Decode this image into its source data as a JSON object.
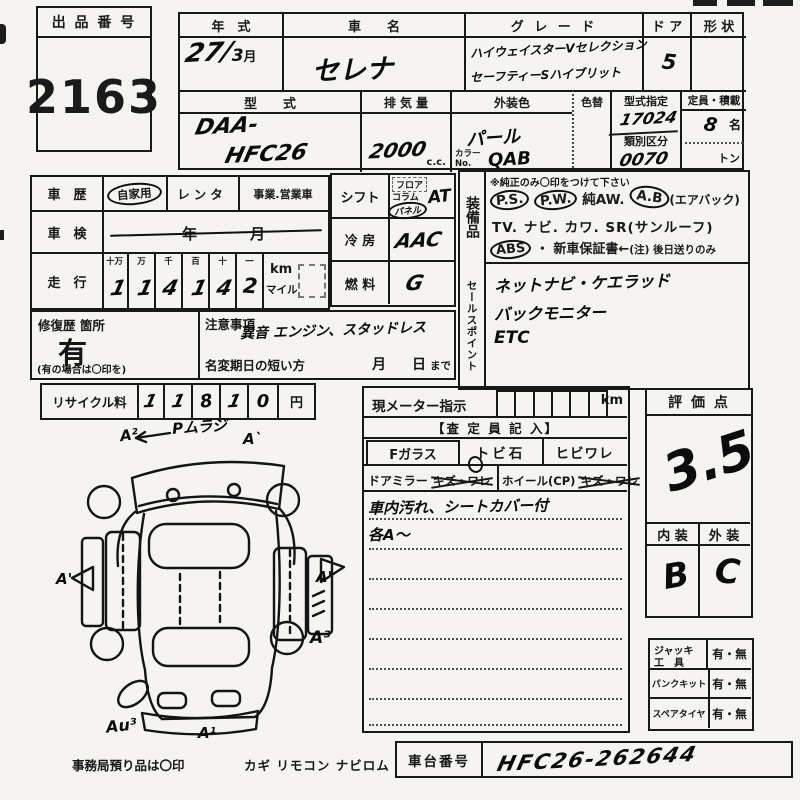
{
  "lot": {
    "label": "出 品 番 号",
    "number": "2163"
  },
  "top": {
    "year": {
      "label": "年　式",
      "value": "27/",
      "month": "3",
      "suffix": "月"
    },
    "name": {
      "label": "車　　名",
      "value": "セレナ"
    },
    "grade": {
      "label": "グ レ ー ド",
      "line1": "ハイウェイスターVセレクション",
      "line2": "セーフティーSハイブリット"
    },
    "door": {
      "label": "ド ア",
      "value": "5"
    },
    "shape": {
      "label": "形 状"
    },
    "model": {
      "label": "型　　式",
      "line1": "DAA-",
      "line2": "HFC26"
    },
    "displacement": {
      "label": "排 気 量",
      "value": "2000",
      "unit": "c.c."
    },
    "ext_color": {
      "label": "外装色",
      "value": "パール",
      "color_no_label": "カラーNo.",
      "color_no": "QAB"
    },
    "color_change": {
      "label": "色替"
    },
    "type_designation": {
      "label": "型式指定",
      "value": "17024"
    },
    "classification": {
      "label": "類別区分",
      "value": "0070"
    },
    "capacity": {
      "label": "定員・積載",
      "persons": "8",
      "persons_unit": "名",
      "load_unit": "トン"
    }
  },
  "history": {
    "label": "車　歴",
    "options": [
      "自家用",
      "レンタ",
      "事業.営業車"
    ],
    "selected": "自家用"
  },
  "inspection": {
    "label": "車　検",
    "year_unit": "年",
    "month_unit": "月"
  },
  "mileage": {
    "label": "走　行",
    "col_headers": [
      "十万",
      "万",
      "千",
      "百",
      "十",
      "一"
    ],
    "digits": [
      "1",
      "1",
      "4",
      "1",
      "4",
      "2"
    ],
    "unit_km": "km",
    "unit_mile": "マイル"
  },
  "shift": {
    "label": "シフト",
    "options": [
      "フロア",
      "コラム",
      "パネル"
    ],
    "selected": "パネル",
    "value": "AT"
  },
  "aircon": {
    "label": "冷 房",
    "value": "AAC"
  },
  "fuel": {
    "label": "燃 料",
    "value": "G"
  },
  "repair": {
    "label": "修復歴 箇所",
    "value": "有",
    "note": "(有の場合は〇印を)"
  },
  "caution": {
    "label": "注意事項",
    "value": "異音 エンジン、スタッドレス",
    "deadline_label": "名変期日の短い方",
    "month": "月",
    "day": "日",
    "made": "まで"
  },
  "recycle": {
    "label": "リサイクル料",
    "digits": [
      "1",
      "1",
      "8",
      "1",
      "0"
    ],
    "unit": "円"
  },
  "equipment": {
    "label": "装備品",
    "note": "※純正のみ〇印をつけて下さい",
    "ps": "P.S.",
    "pw": "P.W.",
    "aw": "純AW.",
    "ab": "A.B",
    "ab_note": "(エアバック)",
    "line2": "TV. ナビ. カワ. SR(サンルーフ)",
    "abs": "ABS",
    "warranty": "・ 新車保証書←",
    "warranty_note": "(注) 後日送りのみ"
  },
  "sales_points": {
    "label": "セールスポイント",
    "lines": [
      "ネットナビ・ケエラッド",
      "バックモニター",
      "ETC"
    ]
  },
  "meter": {
    "label": "現メーター指示",
    "unit": "km",
    "assessor_header": "【査 定 員 記 入】",
    "fglass": "Fガラス",
    "stone": "トビ石",
    "crack": "ヒビワレ",
    "mirror": "ドアミラー",
    "mirror_dmg": "キズ・ワレ",
    "wheel": "ホイール(CP)",
    "wheel_dmg": "キズ・ワレ",
    "notes": [
      "車内汚れ、シートカバー付",
      "各A〜"
    ]
  },
  "evaluation": {
    "label": "評 価 点",
    "score": "3.5",
    "interior_label": "内 装",
    "exterior_label": "外 装",
    "interior": "B",
    "exterior": "C"
  },
  "accessories": {
    "jack_label1": "ジャッキ",
    "jack_label2": "工　具",
    "jack_value": "有・無",
    "puncture_label": "パンクキット",
    "puncture_value": "有・無",
    "spare_label": "スペアタイヤ",
    "spare_value": "有・無"
  },
  "chassis": {
    "label": "車台番号",
    "value": "HFC26-262644"
  },
  "footer": {
    "note": "事務局預り品は〇印",
    "items": "カギ リモコン ナビロム"
  },
  "diagram": {
    "annotations": {
      "a2": "A²",
      "pmura": "Pムラジ",
      "a1_tr": "A`",
      "a1_left": "A'",
      "a1_right": "A'",
      "a3": "A³",
      "au3": "Au³",
      "a1_bottom": "A¹"
    }
  }
}
